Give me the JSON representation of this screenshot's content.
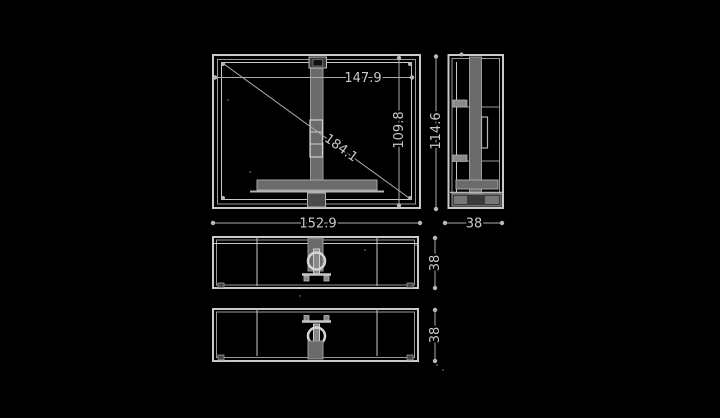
{
  "meta": {
    "type": "technical-dimension-drawing",
    "subject": "flat-panel display three-view drawing with stand"
  },
  "dimensions": {
    "screen_width": "147.9",
    "screen_diagonal": "184.1",
    "screen_height": "109.8",
    "overall_height": "114.6",
    "overall_width": "152.9",
    "depth_side": "38",
    "depth_top_view": "38",
    "depth_bottom_view": "38"
  },
  "colors": {
    "background": "#000000",
    "frame_line": "#c9c9c9",
    "secondary_line": "#9a9a9a",
    "dimension_line": "#ababab",
    "fill_mid": "#6b6b6b",
    "fill_dark": "#3c3c3c",
    "text": "#c9c9c9"
  }
}
